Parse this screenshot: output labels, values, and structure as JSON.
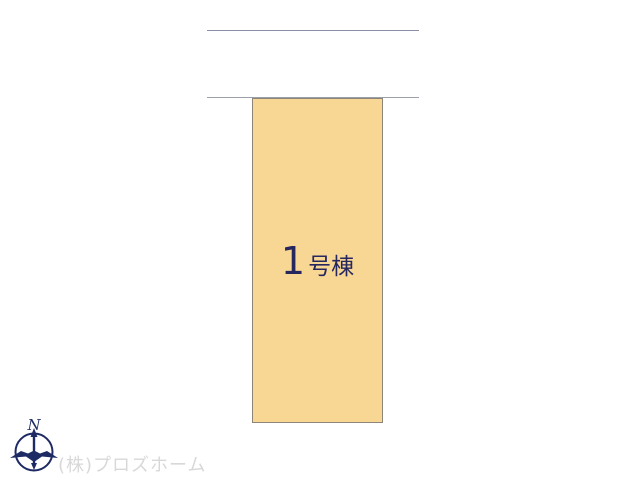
{
  "plan": {
    "building": {
      "label_number": "1",
      "label_suffix": "号棟"
    }
  },
  "compass": {
    "north_label": "N"
  },
  "watermark": {
    "company": "(株)プロズホーム"
  },
  "colors": {
    "page-bg": "#ffffff",
    "line-top": "#8b8fa5",
    "line-bottom": "#9b9fa9",
    "lot-fill": "#f8d795",
    "lot-border": "#8c8578",
    "lot-text": "#272760",
    "compass-color": "#1e2a64",
    "watermark-color": "#d8d8d8"
  }
}
